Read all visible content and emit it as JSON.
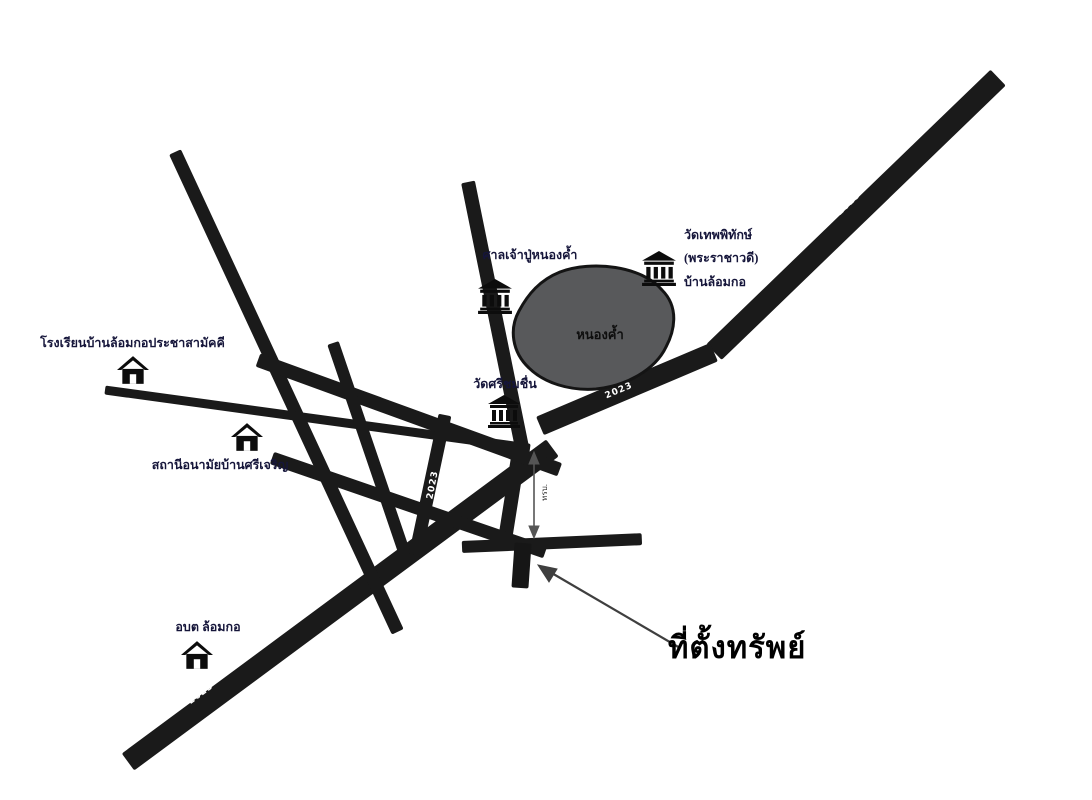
{
  "colors": {
    "road": "#1a1a1a",
    "pond_fill": "#58595b",
    "pond_stroke": "#141414",
    "label_text": "#15153a",
    "road_number_text": "#ffffff"
  },
  "pond": {
    "label": "หนองค้ำ"
  },
  "road_labels": [
    {
      "text": "2023"
    },
    {
      "text": "2023"
    },
    {
      "text": "2023"
    },
    {
      "text": "2023"
    },
    {
      "text": "2023"
    }
  ],
  "places": [
    {
      "name": "shrine-nong-kham",
      "icon": "temple",
      "label": "ศาลเจ้าปู่หนองค้ำ"
    },
    {
      "name": "wat-thep-phithak",
      "icon": "temple",
      "lines": [
        "วัดเทพพิทักษ์",
        "(พระราชาวดี)",
        "บ้านล้อมกอ"
      ]
    },
    {
      "name": "wat-si-chom-chuen",
      "icon": "temple",
      "label": "วัดศรีชมชื่น"
    },
    {
      "name": "school-ban-lom-ko",
      "icon": "house",
      "label": "โรงเรียนบ้านล้อมกอประชาสามัคคี"
    },
    {
      "name": "health-station",
      "icon": "house",
      "label": "สถานีอนามัยบ้านศรีเจริญ"
    },
    {
      "name": "sao-lom-ko",
      "icon": "house",
      "label": "อบต ล้อมกอ"
    }
  ],
  "annotations": {
    "property_label": "ที่ตั้งทรัพย์",
    "culvert_label": "ทรบ."
  }
}
